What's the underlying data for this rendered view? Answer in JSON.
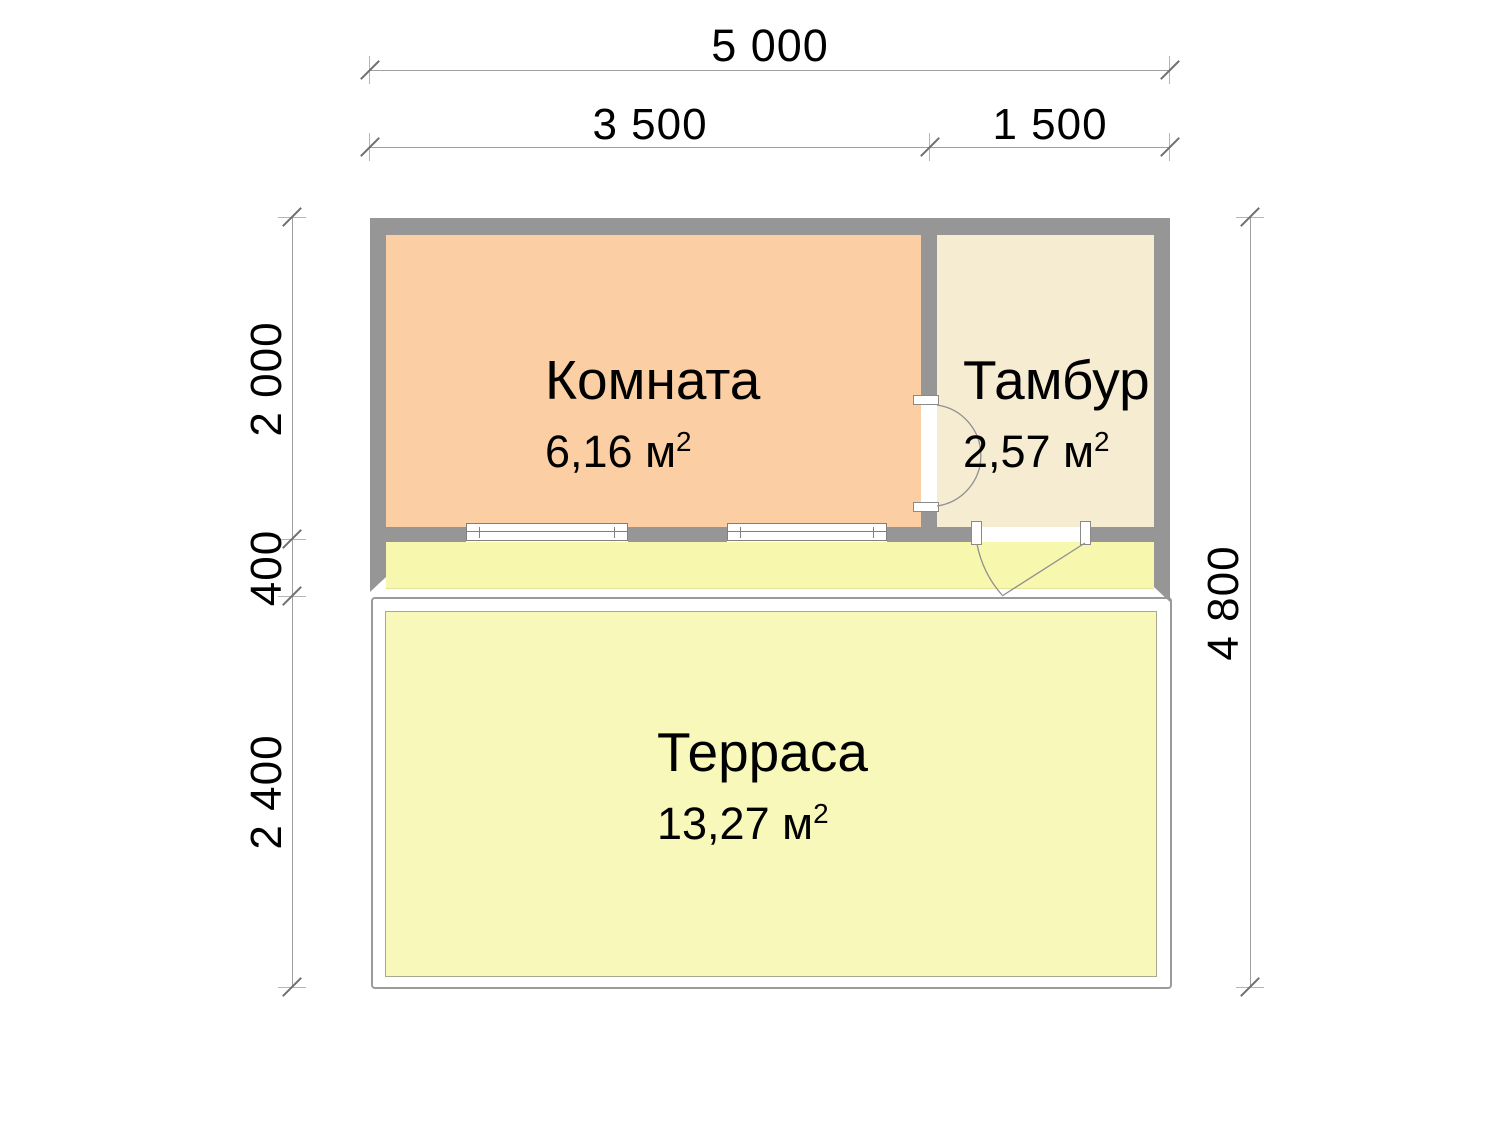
{
  "plan": {
    "rooms": [
      {
        "name": "Комната",
        "area": "6,16 м",
        "area_sup": "2"
      },
      {
        "name": "Тамбур",
        "area": "2,57 м",
        "area_sup": "2"
      },
      {
        "name": "Терраса",
        "area": "13,27 м",
        "area_sup": "2"
      }
    ],
    "dimensions": {
      "top_total": "5 000",
      "top_room": "3 500",
      "top_tambour": "1 500",
      "side_room": "2 000",
      "side_porch": "400",
      "side_terrace": "2 400",
      "side_total": "4 800"
    },
    "colors": {
      "room_fill": "#fbcfa3",
      "tambour_fill": "#f5ecd2",
      "porch_fill": "#f7f7ae",
      "terrace_fill": "#f8f8ba",
      "wall": "#969696",
      "dimension_line": "#a0a0a0",
      "text": "#000000"
    }
  }
}
